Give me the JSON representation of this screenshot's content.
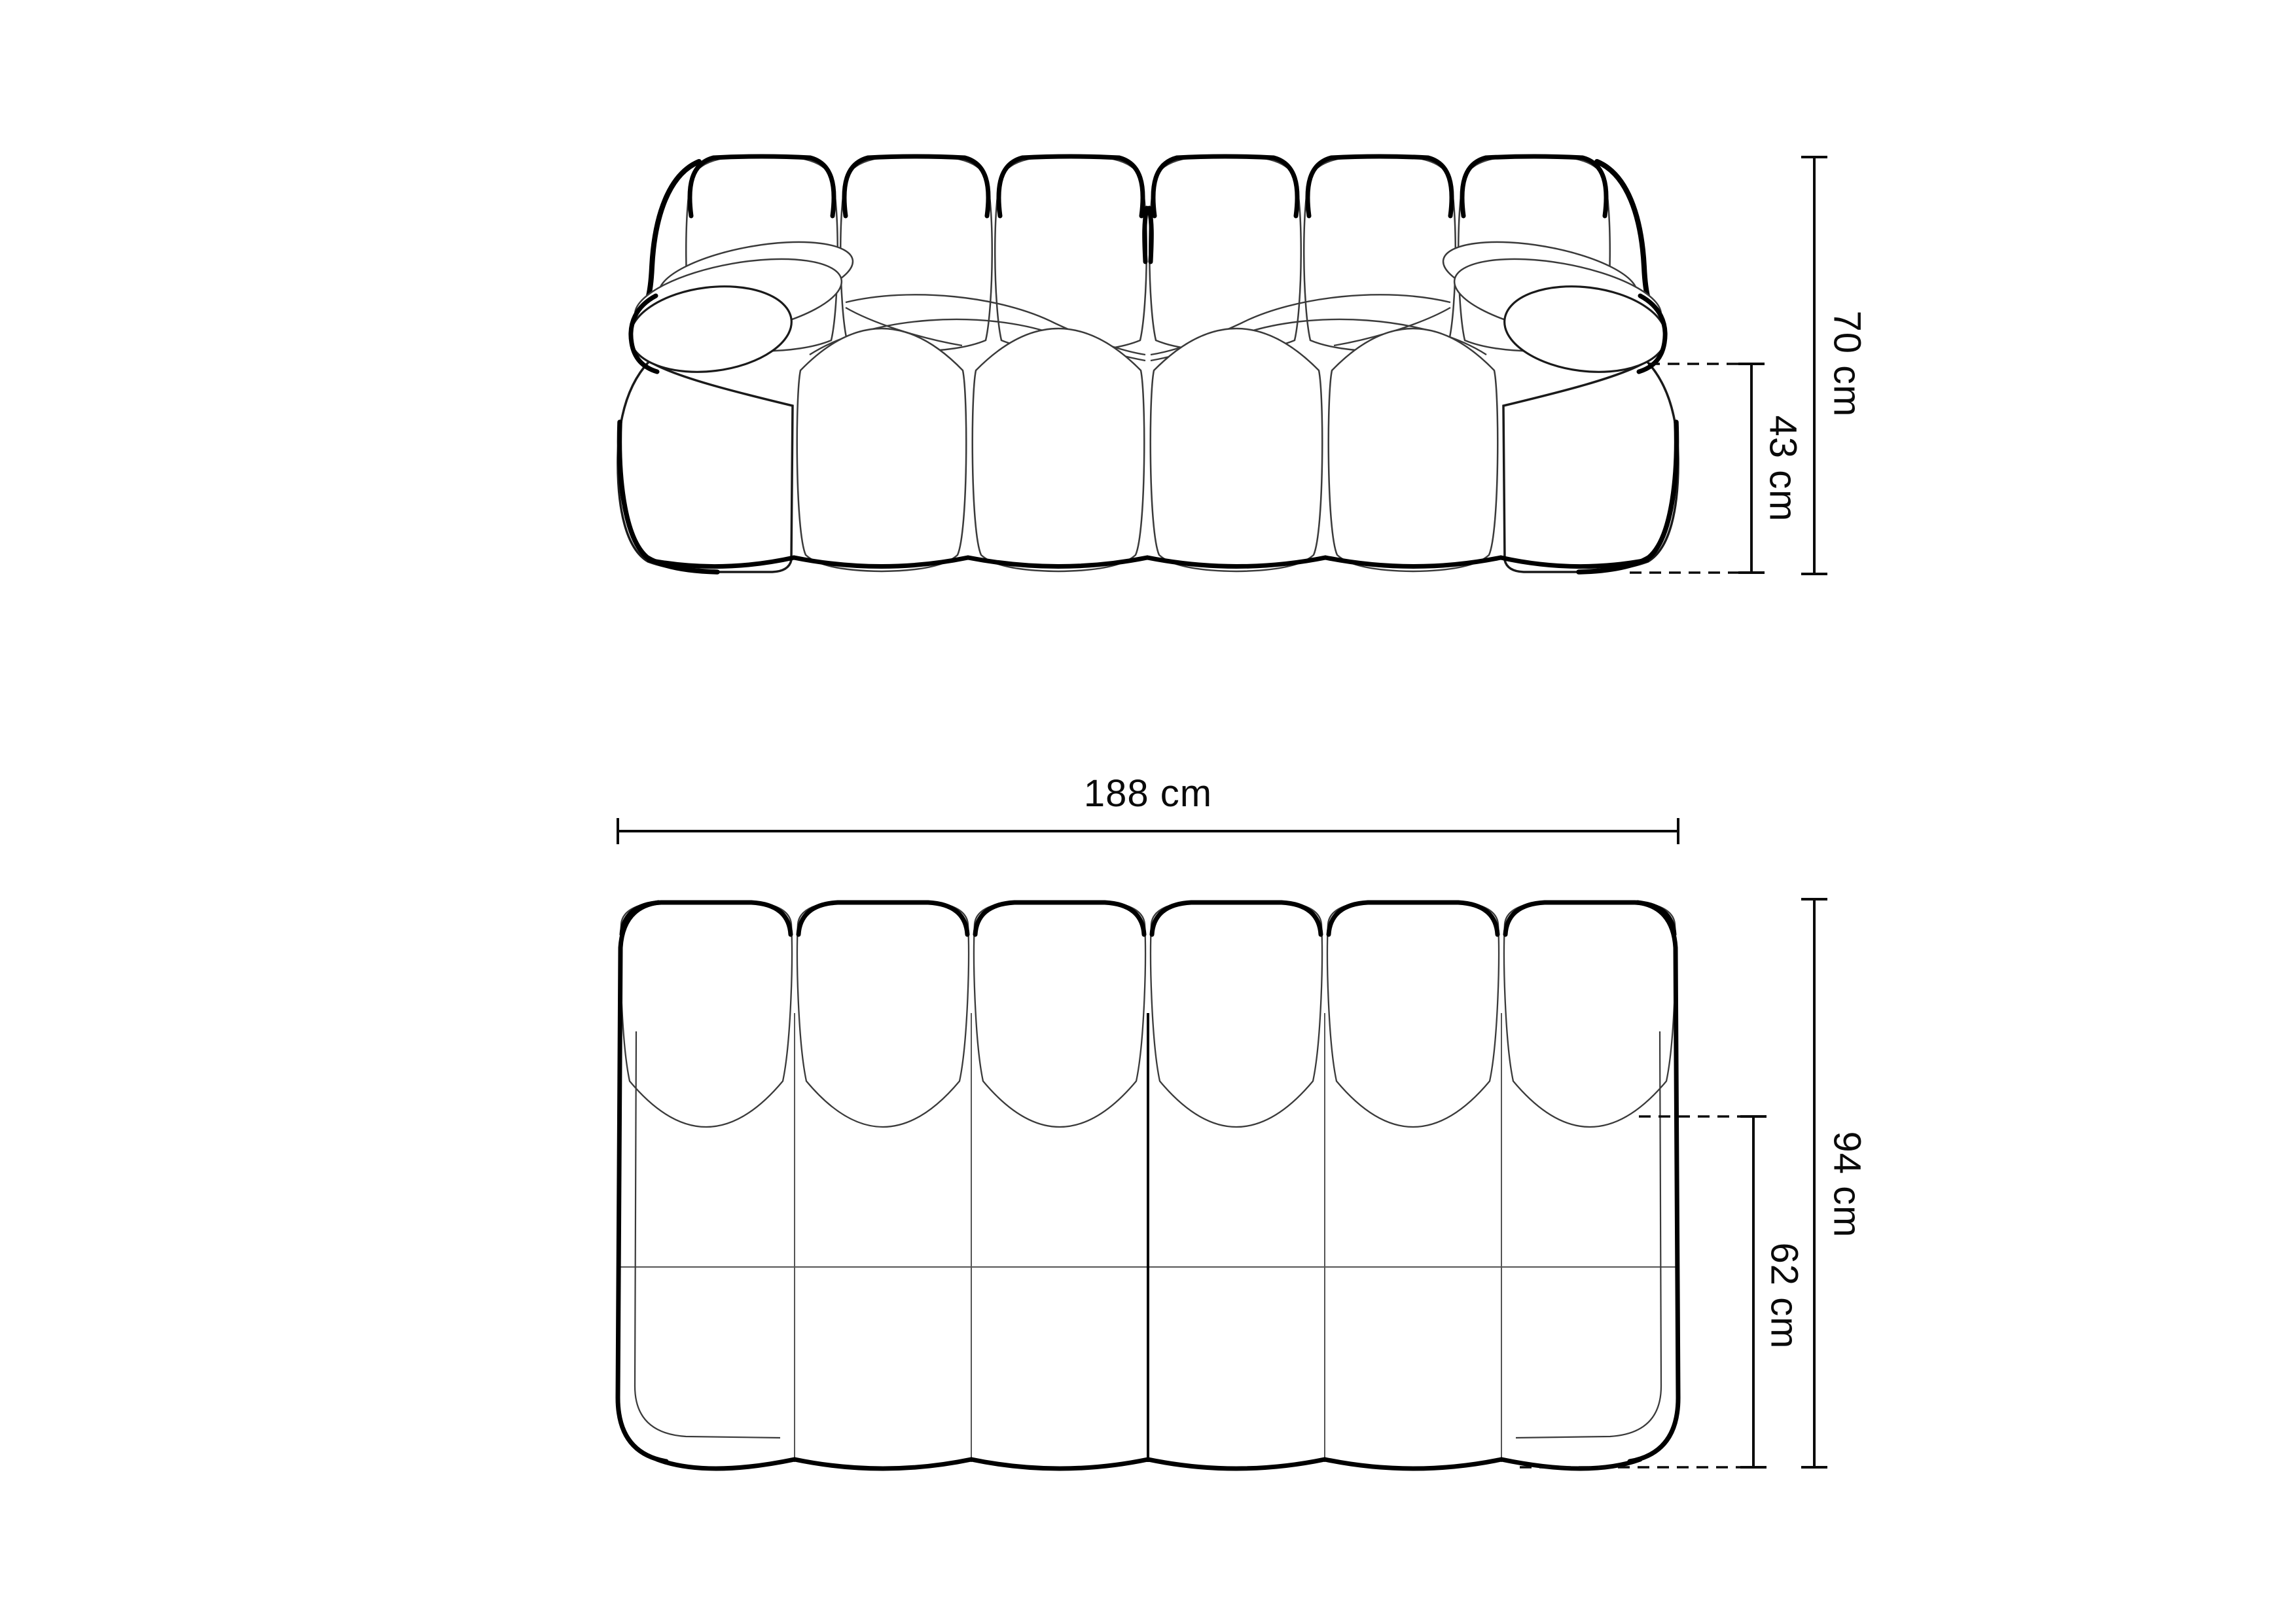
{
  "colors": {
    "background": "#ffffff",
    "outline": "#000000",
    "thin_seam": "#3a3a3a",
    "dimension": "#0a0a0a"
  },
  "front_view": {
    "dimensions": {
      "overall_height": "70 cm",
      "arm_height": "43 cm"
    }
  },
  "top_view": {
    "dimensions": {
      "overall_width": "188 cm",
      "overall_depth": "94 cm",
      "seat_depth": "62 cm"
    }
  }
}
